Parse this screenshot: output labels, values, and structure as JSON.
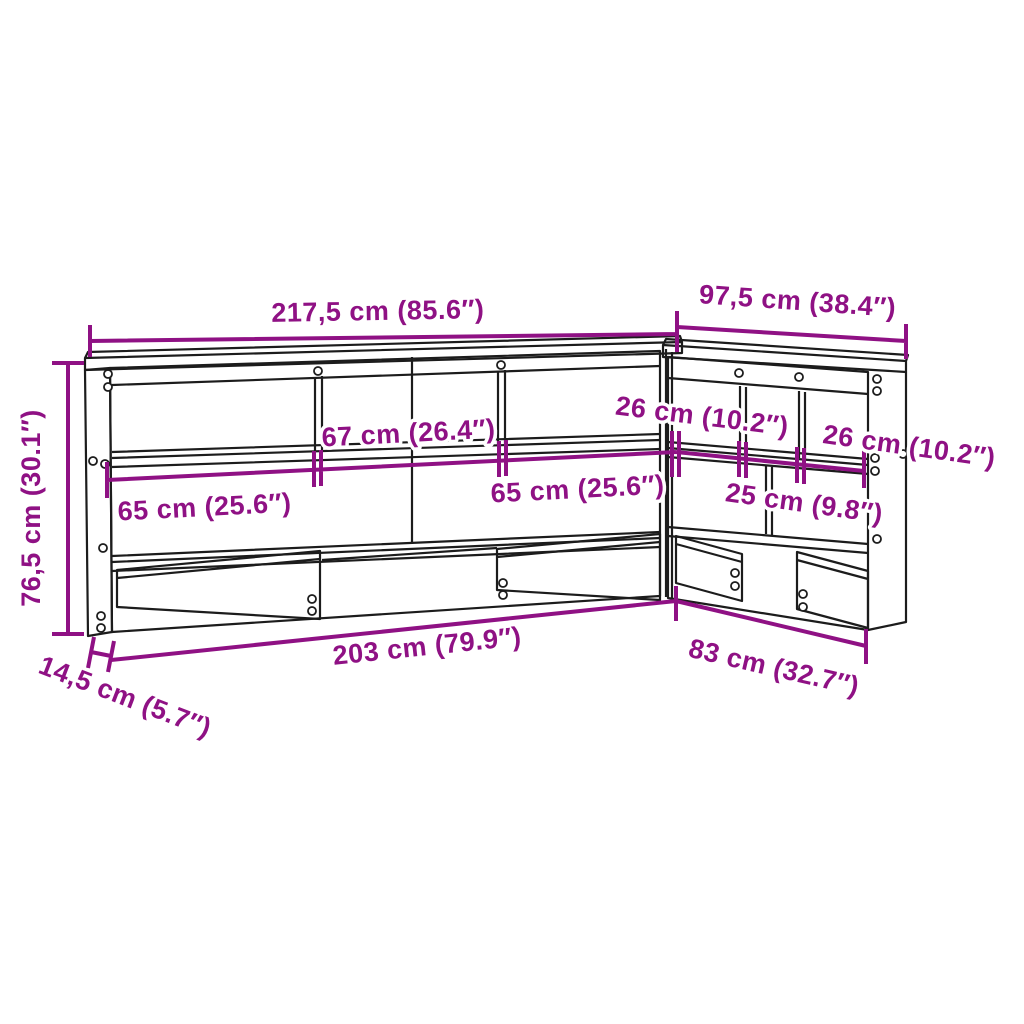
{
  "diagram": {
    "type": "furniture-dimension-drawing",
    "object": "L-shaped bookcase headboard line drawing",
    "dims": {
      "top_width": "217,5 cm (85.6″)",
      "right_width": "97,5 cm (38.4″)",
      "height": "76,5 cm (30.1″)",
      "depth": "14,5 cm (5.7″)",
      "shelf_left": "65 cm (25.6″)",
      "shelf_center": "67 cm (26.4″)",
      "shelf_right": "65 cm (25.6″)",
      "wing_shelf_first": "26 cm (10.2″)",
      "wing_shelf_middle": "25 cm (9.8″)",
      "wing_shelf_last": "26 cm (10.2″)",
      "bottom_width": "203 cm (79.9″)",
      "wing_bottom_width": "83 cm (32.7″)"
    },
    "colors": {
      "dimension": "#8F1184",
      "line": "#1C1C1C",
      "background": "#FFFFFF"
    }
  }
}
